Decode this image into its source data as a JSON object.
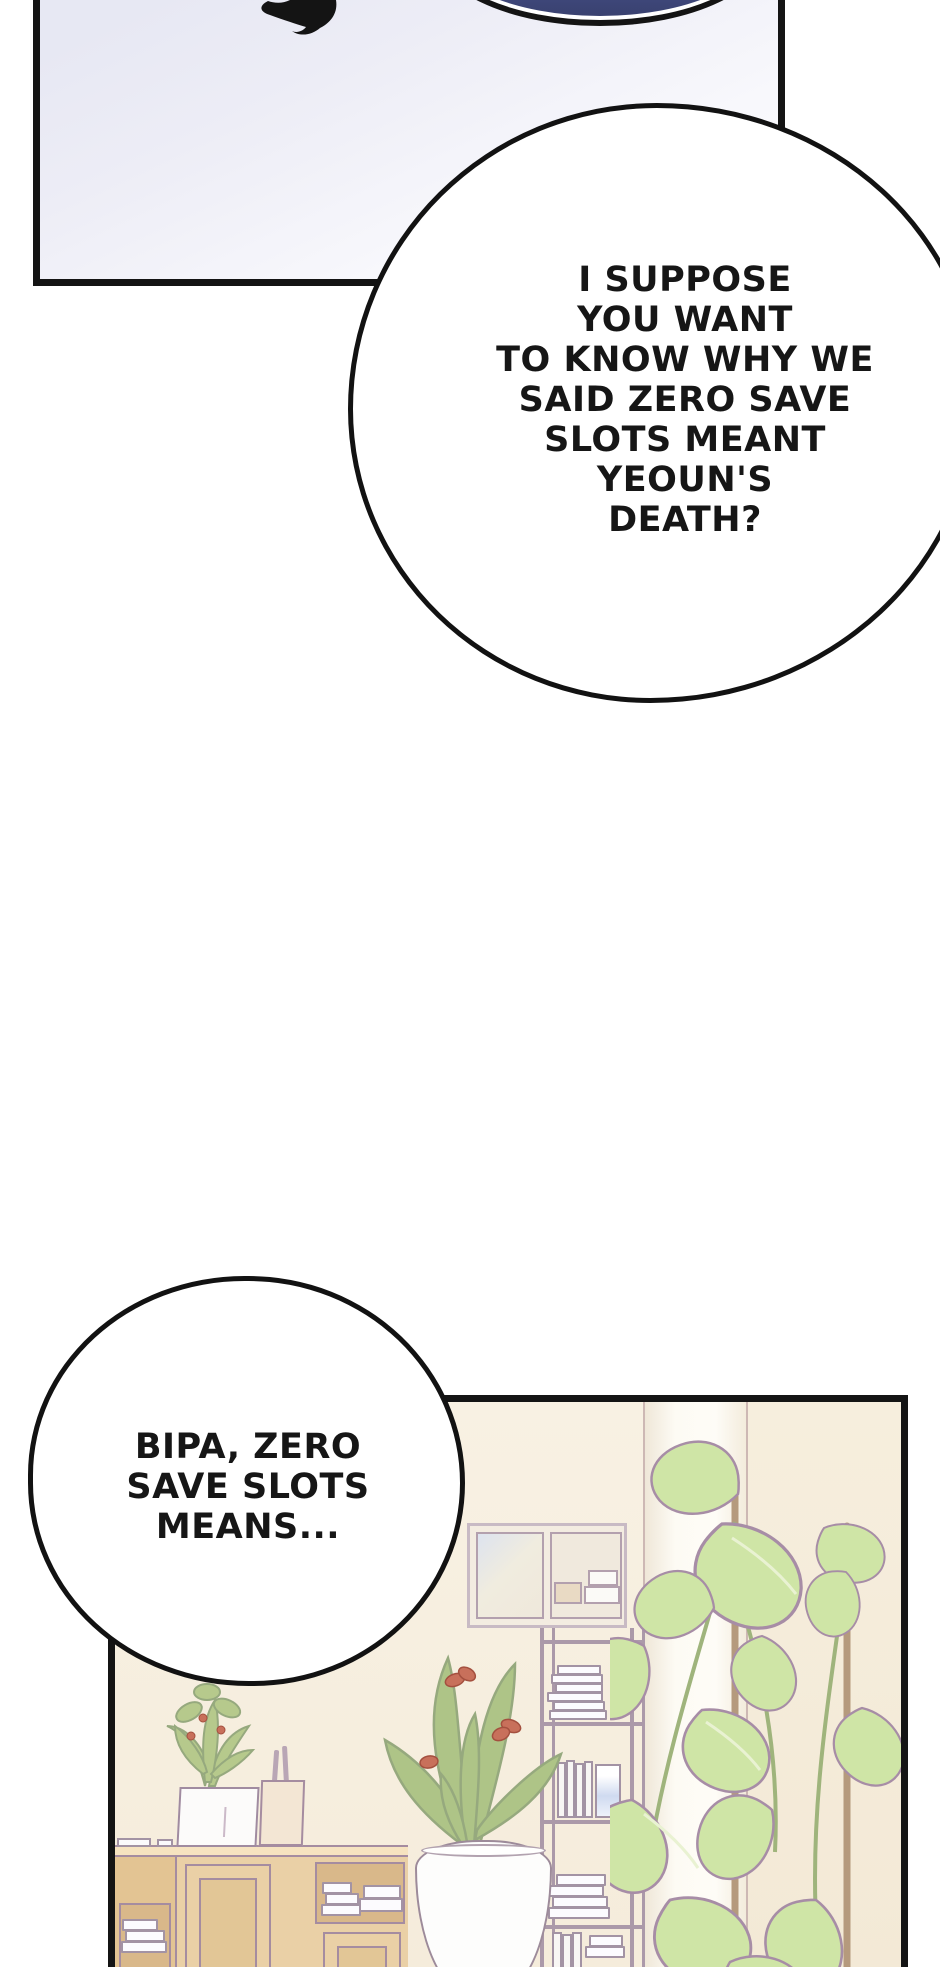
{
  "bubbles": {
    "large": {
      "lines": [
        "I SUPPOSE",
        "YOU WANT",
        "TO KNOW WHY WE",
        "SAID ZERO SAVE",
        "SLOTS MEANT",
        "YEOUN'S",
        "DEATH?"
      ]
    },
    "small": {
      "lines": [
        "BIPA, ZERO",
        "SAVE SLOTS",
        "MEANS..."
      ]
    }
  },
  "colors": {
    "ink_outline": "#141414",
    "panel_tint_lavender": "#e7e8f3",
    "dark_bubble_navy": "#414a80",
    "room_wall_cream": "#f7f0e0",
    "pillar_white": "#fdfbf4",
    "wood_tan": "#ead0a6",
    "leaf_green": "#cfe5a6",
    "leaf_olive": "#b6c98c",
    "flower_rust": "#c8705b",
    "outline_mauve": "#a78da6",
    "book_white": "#fcfbfe",
    "book_cover_blue": "#cfdaf0"
  }
}
